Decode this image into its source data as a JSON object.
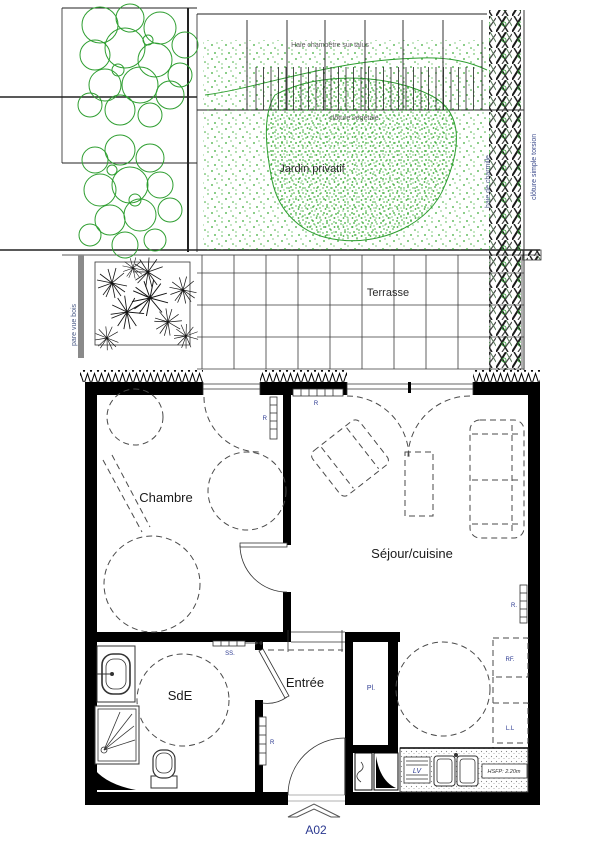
{
  "colors": {
    "vegetation": "#2e9e30",
    "label_navy": "#2b3990",
    "walls": "#000000"
  },
  "garden": {
    "hedge_top_label": "Haie champêtre sur talus",
    "fence_mid_label": "clôture végétale",
    "label": "Jardin privatif",
    "hedge_right_label": "haie de charmille",
    "fence_right_label": "clôture simple torsion"
  },
  "terrace": {
    "label": "Terrasse",
    "screen_label": "pare vue bois"
  },
  "rooms": {
    "bedroom": "Chambre",
    "living": "Séjour/cuisine",
    "bathroom": "SdE",
    "entrance": "Entrée"
  },
  "fixtures": {
    "closet": "Pl.",
    "fridge": "RF.",
    "washer": "L.L",
    "dishwasher": "LV",
    "towel_dryer": "SS.",
    "radiator": "R",
    "radiator_dot": "R.",
    "ceiling_height": "HSFP: 2.20m"
  },
  "plan": {
    "ref": "A02"
  }
}
